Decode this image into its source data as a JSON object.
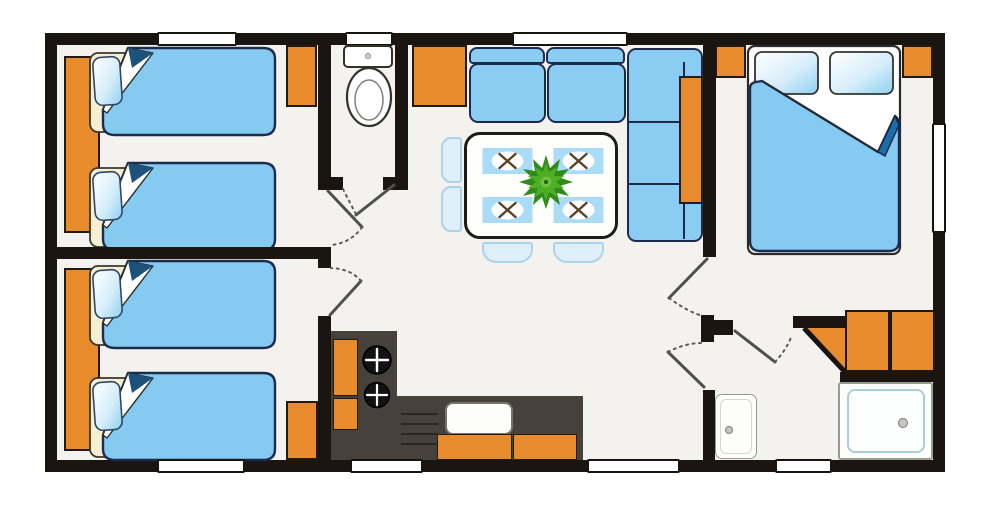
{
  "meta": {
    "title": "Mobile home floor plan",
    "canvas_width": 1000,
    "canvas_height": 515
  },
  "colors": {
    "wall": "#1a1510",
    "floor": "#f3f2ee",
    "orange": "#e78b2d",
    "bed_blue": "#85caf0",
    "navy": "#1d2c4e",
    "sofa_blue": "#8bccf2",
    "mat_blue": "#aadcf7",
    "chair_blue": "#dff0fa",
    "chair_border": "#aad4ec",
    "counter": "#46413a",
    "cream": "#f7efd2",
    "green_dark": "#2f8c19",
    "green_mid": "#4fae27",
    "green_light": "#6cc43e",
    "door_line": "#4f4f4f",
    "accent_fold": "#1a6cab",
    "cutlery": "#5c4123"
  },
  "rooms": [
    {
      "id": "bedroom-1",
      "name": "Twin bedroom 1",
      "furniture": [
        "wardrobe",
        "twin bed",
        "twin bed",
        "cabinet"
      ]
    },
    {
      "id": "bedroom-2",
      "name": "Twin bedroom 2",
      "furniture": [
        "wardrobe",
        "twin bed",
        "twin bed",
        "cabinet"
      ]
    },
    {
      "id": "wc",
      "name": "WC",
      "furniture": [
        "toilet"
      ]
    },
    {
      "id": "living-dining",
      "name": "Living / dining area",
      "furniture": [
        "corner sofa",
        "side console",
        "dining table",
        "placemat x4",
        "house plant",
        "chair x4",
        "cabinet"
      ]
    },
    {
      "id": "kitchen",
      "name": "Kitchen",
      "furniture": [
        "L-shaped counter",
        "hob with 2 burners",
        "sink",
        "drainer",
        "cabinet doors"
      ]
    },
    {
      "id": "master-bedroom",
      "name": "Master bedroom",
      "furniture": [
        "double bed",
        "pillow x2",
        "bedside cabinet x2"
      ]
    },
    {
      "id": "bathroom",
      "name": "Shower room",
      "furniture": [
        "shower tray",
        "washbasin",
        "corner storage unit"
      ]
    },
    {
      "id": "hallway",
      "name": "Hallway",
      "furniture": []
    }
  ],
  "openings": {
    "windows_total": 8,
    "doors_total": 6,
    "window_style": "white slot in wall",
    "door_style": "quarter-swing panel with dashed arc"
  }
}
